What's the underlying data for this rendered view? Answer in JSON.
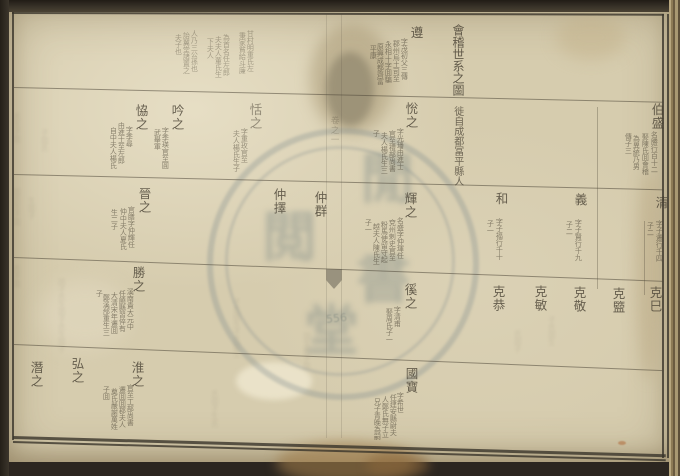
{
  "document": {
    "kind": "chinese-genealogy-chart-scan",
    "title": "會稽世系之圖",
    "title_annotation": "徙自成都冨平縣人",
    "fold_label": "卷之一",
    "fold_number": "556"
  },
  "seal": {
    "glyphs": [
      "閒",
      "閲",
      "書",
      "堂"
    ]
  },
  "colors": {
    "paper": "#d6ccae",
    "ink": "#453e31",
    "frame_edge": "#3a342a",
    "seal_blue_gray": "#7c898c",
    "stain_brown": "#9e7c4a",
    "table_tan": "#b7a77e"
  },
  "genealogy": {
    "entries": [
      {
        "n": "遵",
        "x": 409,
        "y": 26,
        "notes": [
          {
            "t": "字茂初父三傳",
            "x": 400,
            "y": 38
          },
          {
            "t": "郡州烏土司至",
            "x": 392,
            "y": 40
          },
          {
            "t": "永相十字囬騙",
            "x": 384,
            "y": 41
          },
          {
            "t": "原興成都齊富",
            "x": 376,
            "y": 43
          },
          {
            "t": "平康",
            "x": 369,
            "y": 45
          }
        ]
      },
      {
        "n": "",
        "x": 246,
        "y": 28,
        "o": 0.4,
        "notes": [
          {
            "t": "甘村明重氏左",
            "x": 246,
            "y": 30
          },
          {
            "t": "秉家貧給斗廉",
            "x": 238,
            "y": 32
          },
          {
            "t": "為首名任左郎",
            "x": 222,
            "y": 34
          },
          {
            "t": "夫夫人董氏生",
            "x": 214,
            "y": 36
          },
          {
            "t": "下夫人",
            "x": 206,
            "y": 38
          },
          {
            "t": "人乃三公孫也",
            "x": 190,
            "y": 30
          },
          {
            "t": "詒翼堂諸置之",
            "x": 182,
            "y": 32
          },
          {
            "t": "夫子也",
            "x": 174,
            "y": 34
          }
        ]
      },
      {
        "n": "伯盛",
        "x": 650,
        "y": 103,
        "notes": [
          {
            "t": "名勝行百十二",
            "x": 650,
            "y": 131
          },
          {
            "t": "娶陳氏囬會稽",
            "x": 641,
            "y": 133
          },
          {
            "t": "為異統乃男",
            "x": 632,
            "y": 135
          },
          {
            "t": "傳子三",
            "x": 624,
            "y": 133
          }
        ]
      },
      {
        "n": "恱之",
        "x": 404,
        "y": 102,
        "notes": [
          {
            "t": "字光璠由進士",
            "x": 396,
            "y": 128
          },
          {
            "t": "官至禮部尚書",
            "x": 388,
            "y": 130
          },
          {
            "t": "夫人楊氏生三",
            "x": 380,
            "y": 132
          },
          {
            "t": "子",
            "x": 372,
            "y": 130
          }
        ]
      },
      {
        "n": "恬之",
        "x": 248,
        "y": 103,
        "o": 0.5,
        "notes": [
          {
            "t": "字重玫官至",
            "x": 240,
            "y": 128
          },
          {
            "t": "夫人楊氏生子",
            "x": 232,
            "y": 130
          }
        ]
      },
      {
        "n": "吟之",
        "x": 170,
        "y": 104,
        "notes": [
          {
            "t": "字季瑛官至圓",
            "x": 161,
            "y": 127
          },
          {
            "t": "武舉軍",
            "x": 153,
            "y": 129
          }
        ]
      },
      {
        "n": "恊之",
        "x": 134,
        "y": 104,
        "notes": [
          {
            "t": "字季尋",
            "x": 125,
            "y": 126
          },
          {
            "t": "由進士至左郎",
            "x": 117,
            "y": 122
          },
          {
            "t": "自中夫人楊氏",
            "x": 109,
            "y": 127
          }
        ]
      },
      {
        "n": "清",
        "x": 654,
        "y": 196,
        "notes": [
          {
            "t": "字子遷行千四",
            "x": 655,
            "y": 220
          },
          {
            "t": "子二",
            "x": 646,
            "y": 222
          }
        ]
      },
      {
        "n": "義",
        "x": 573,
        "y": 193,
        "notes": [
          {
            "t": "字子賢行千九",
            "x": 574,
            "y": 219
          },
          {
            "t": "子二",
            "x": 565,
            "y": 221
          }
        ]
      },
      {
        "n": "和",
        "x": 494,
        "y": 192,
        "notes": [
          {
            "t": "字子福行千十",
            "x": 495,
            "y": 218
          },
          {
            "t": "子一",
            "x": 486,
            "y": 220
          }
        ]
      },
      {
        "n": "輝之",
        "x": 403,
        "y": 192,
        "notes": [
          {
            "t": "名盛字仲琿任",
            "x": 396,
            "y": 217
          },
          {
            "t": "兗州剌史官至",
            "x": 388,
            "y": 219
          },
          {
            "t": "粉馬使留守起",
            "x": 380,
            "y": 221
          },
          {
            "t": "越夫人陳氏生",
            "x": 372,
            "y": 223
          },
          {
            "t": "子一",
            "x": 364,
            "y": 219
          }
        ]
      },
      {
        "n": "仲群",
        "x": 313,
        "y": 191
      },
      {
        "n": "仲擇",
        "x": 272,
        "y": 188
      },
      {
        "n": "晉之",
        "x": 137,
        "y": 187,
        "notes": [
          {
            "t": "官膳字仲輝任",
            "x": 127,
            "y": 206
          },
          {
            "t": "仲中夫人夏氏",
            "x": 119,
            "y": 208
          },
          {
            "t": "生二子",
            "x": 110,
            "y": 209
          }
        ]
      },
      {
        "n": "克巳",
        "x": 648,
        "y": 286
      },
      {
        "n": "克盬",
        "x": 611,
        "y": 287
      },
      {
        "n": "克敬",
        "x": 572,
        "y": 286
      },
      {
        "n": "克敏",
        "x": 533,
        "y": 285
      },
      {
        "n": "克恭",
        "x": 491,
        "y": 285
      },
      {
        "n": "徯之",
        "x": 403,
        "y": 283,
        "notes": [
          {
            "t": "字清甫",
            "x": 393,
            "y": 306
          },
          {
            "t": "娶周氏子一",
            "x": 385,
            "y": 308
          }
        ]
      },
      {
        "n": "勝之",
        "x": 131,
        "y": 266,
        "notes": [
          {
            "t": "溪南貴大元中",
            "x": 126,
            "y": 288
          },
          {
            "t": "任饒縣習倅有",
            "x": 118,
            "y": 290
          },
          {
            "t": "大清宋年遷囬",
            "x": 110,
            "y": 292
          },
          {
            "t": "鄭溪郃重生三",
            "x": 102,
            "y": 294
          },
          {
            "t": "子",
            "x": 95,
            "y": 290
          }
        ]
      },
      {
        "n": "國寶",
        "x": 404,
        "y": 367,
        "notes": [
          {
            "t": "字希世",
            "x": 396,
            "y": 392
          },
          {
            "t": "任建安縣尉夫",
            "x": 389,
            "y": 394
          },
          {
            "t": "人鄭氏無子立",
            "x": 381,
            "y": 396
          },
          {
            "t": "兄子青晚為嗣",
            "x": 373,
            "y": 398
          }
        ]
      },
      {
        "n": "淮之",
        "x": 130,
        "y": 361,
        "notes": [
          {
            "t": "官至工部尚書",
            "x": 126,
            "y": 384
          },
          {
            "t": "遷囬囬郡夫人",
            "x": 118,
            "y": 386
          },
          {
            "t": "奠氏嚴謝萬姓",
            "x": 110,
            "y": 388
          },
          {
            "t": "子囬",
            "x": 102,
            "y": 386
          }
        ]
      },
      {
        "n": "弘之",
        "x": 70,
        "y": 357
      },
      {
        "n": "潛之",
        "x": 29,
        "y": 361
      }
    ],
    "bleedthrough_marks": [
      {
        "t": "氏生子囬",
        "x": 12,
        "y": 113
      },
      {
        "t": "子囬氏",
        "x": 40,
        "y": 129
      },
      {
        "t": "囬氏生子囬",
        "x": 12,
        "y": 188
      },
      {
        "t": "生囬子",
        "x": 27,
        "y": 197
      },
      {
        "t": "氏子囬",
        "x": 12,
        "y": 265
      },
      {
        "t": "囬子氏生囬子氏生囬子",
        "x": 57,
        "y": 278
      },
      {
        "t": "子氏囬生子氏囬生",
        "x": 232,
        "y": 298
      },
      {
        "t": "氏囬子生氏",
        "x": 210,
        "y": 390
      },
      {
        "t": "囬生氏子囬",
        "x": 302,
        "y": 332
      },
      {
        "t": "子氏囬生",
        "x": 547,
        "y": 316
      },
      {
        "t": "氏囬子",
        "x": 513,
        "y": 330
      }
    ]
  }
}
